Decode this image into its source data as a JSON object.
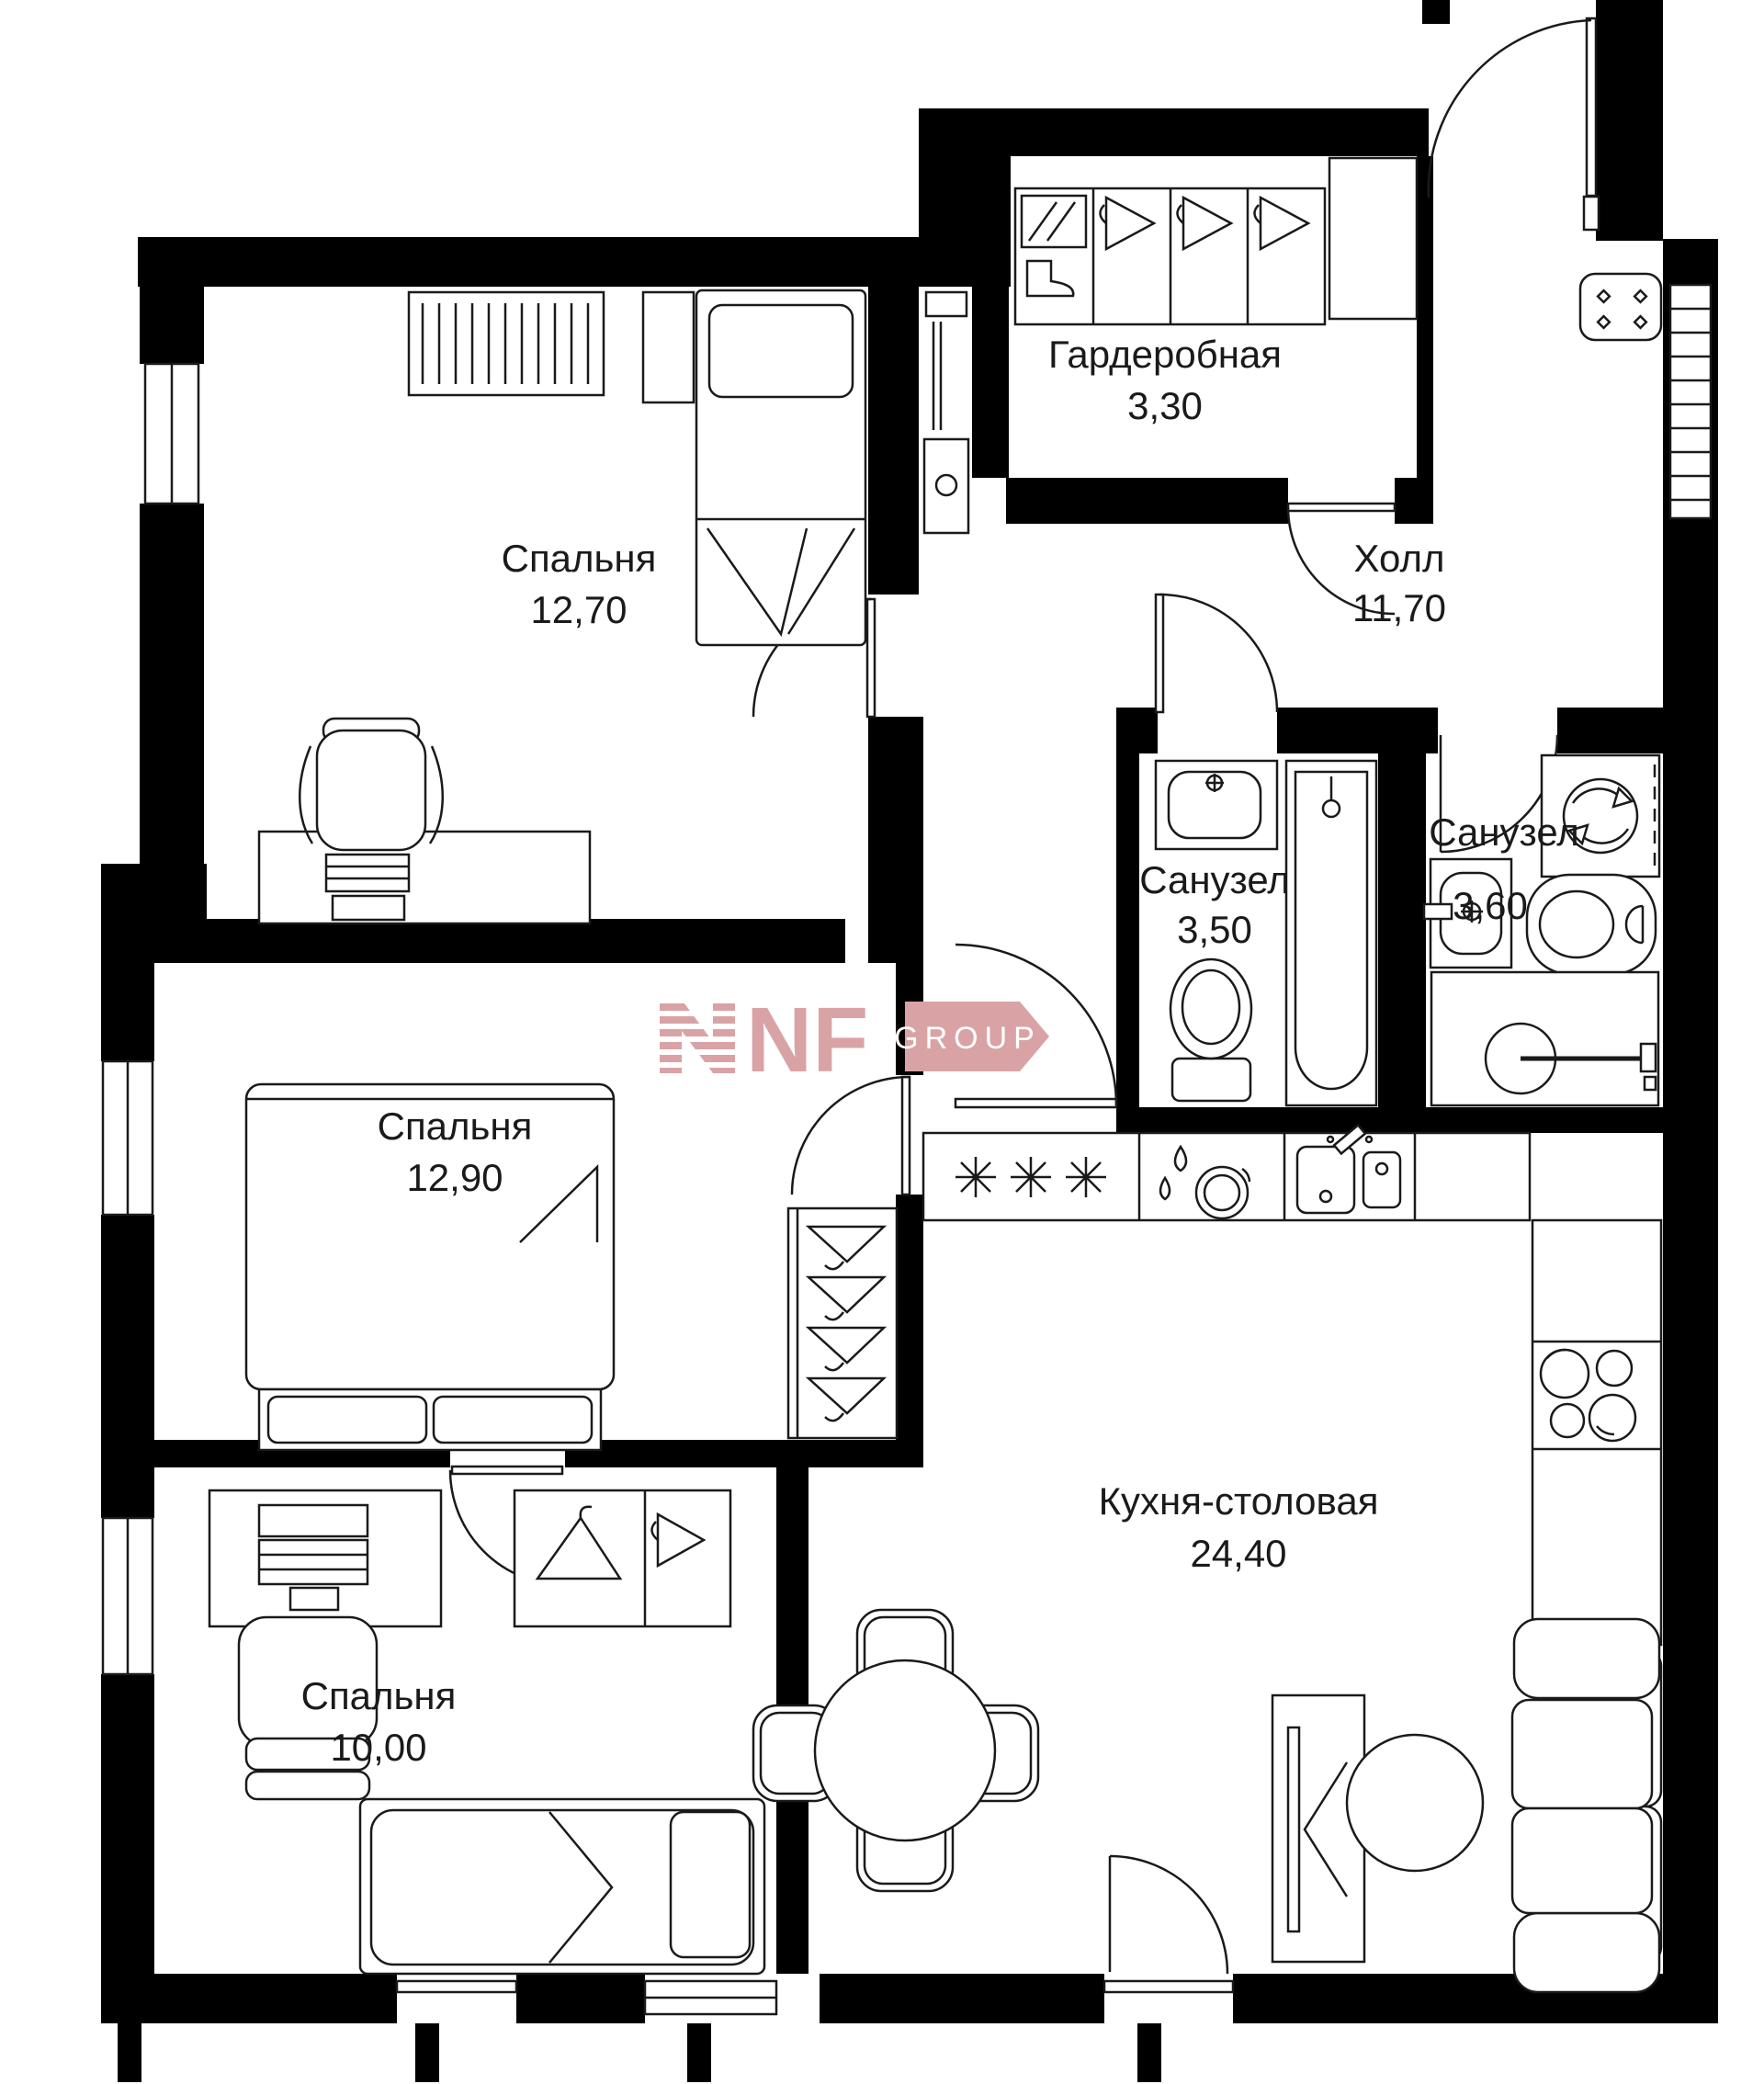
{
  "plan": {
    "type": "apartment-floor-plan",
    "rooms": [
      {
        "id": "bedroom-1",
        "name": "Спальня",
        "area": "12,70"
      },
      {
        "id": "wardrobe",
        "name": "Гардеробная",
        "area": "3,30"
      },
      {
        "id": "hall",
        "name": "Холл",
        "area": "11,70"
      },
      {
        "id": "bathroom-1",
        "name": "Санузел",
        "area": "3,50"
      },
      {
        "id": "bathroom-2",
        "name": "Санузел",
        "area": "3,60"
      },
      {
        "id": "bedroom-2",
        "name": "Спальня",
        "area": "12,90"
      },
      {
        "id": "kitchen-dining",
        "name": "Кухня-столовая",
        "area": "24,40"
      },
      {
        "id": "bedroom-3",
        "name": "Спальня",
        "area": "10,00"
      }
    ],
    "logo": {
      "letters": "NF",
      "group": "GROUP",
      "color": "#d9a3a6"
    },
    "colors": {
      "walls": "#000000",
      "lines": "#1a1a1a",
      "background": "#ffffff"
    }
  }
}
